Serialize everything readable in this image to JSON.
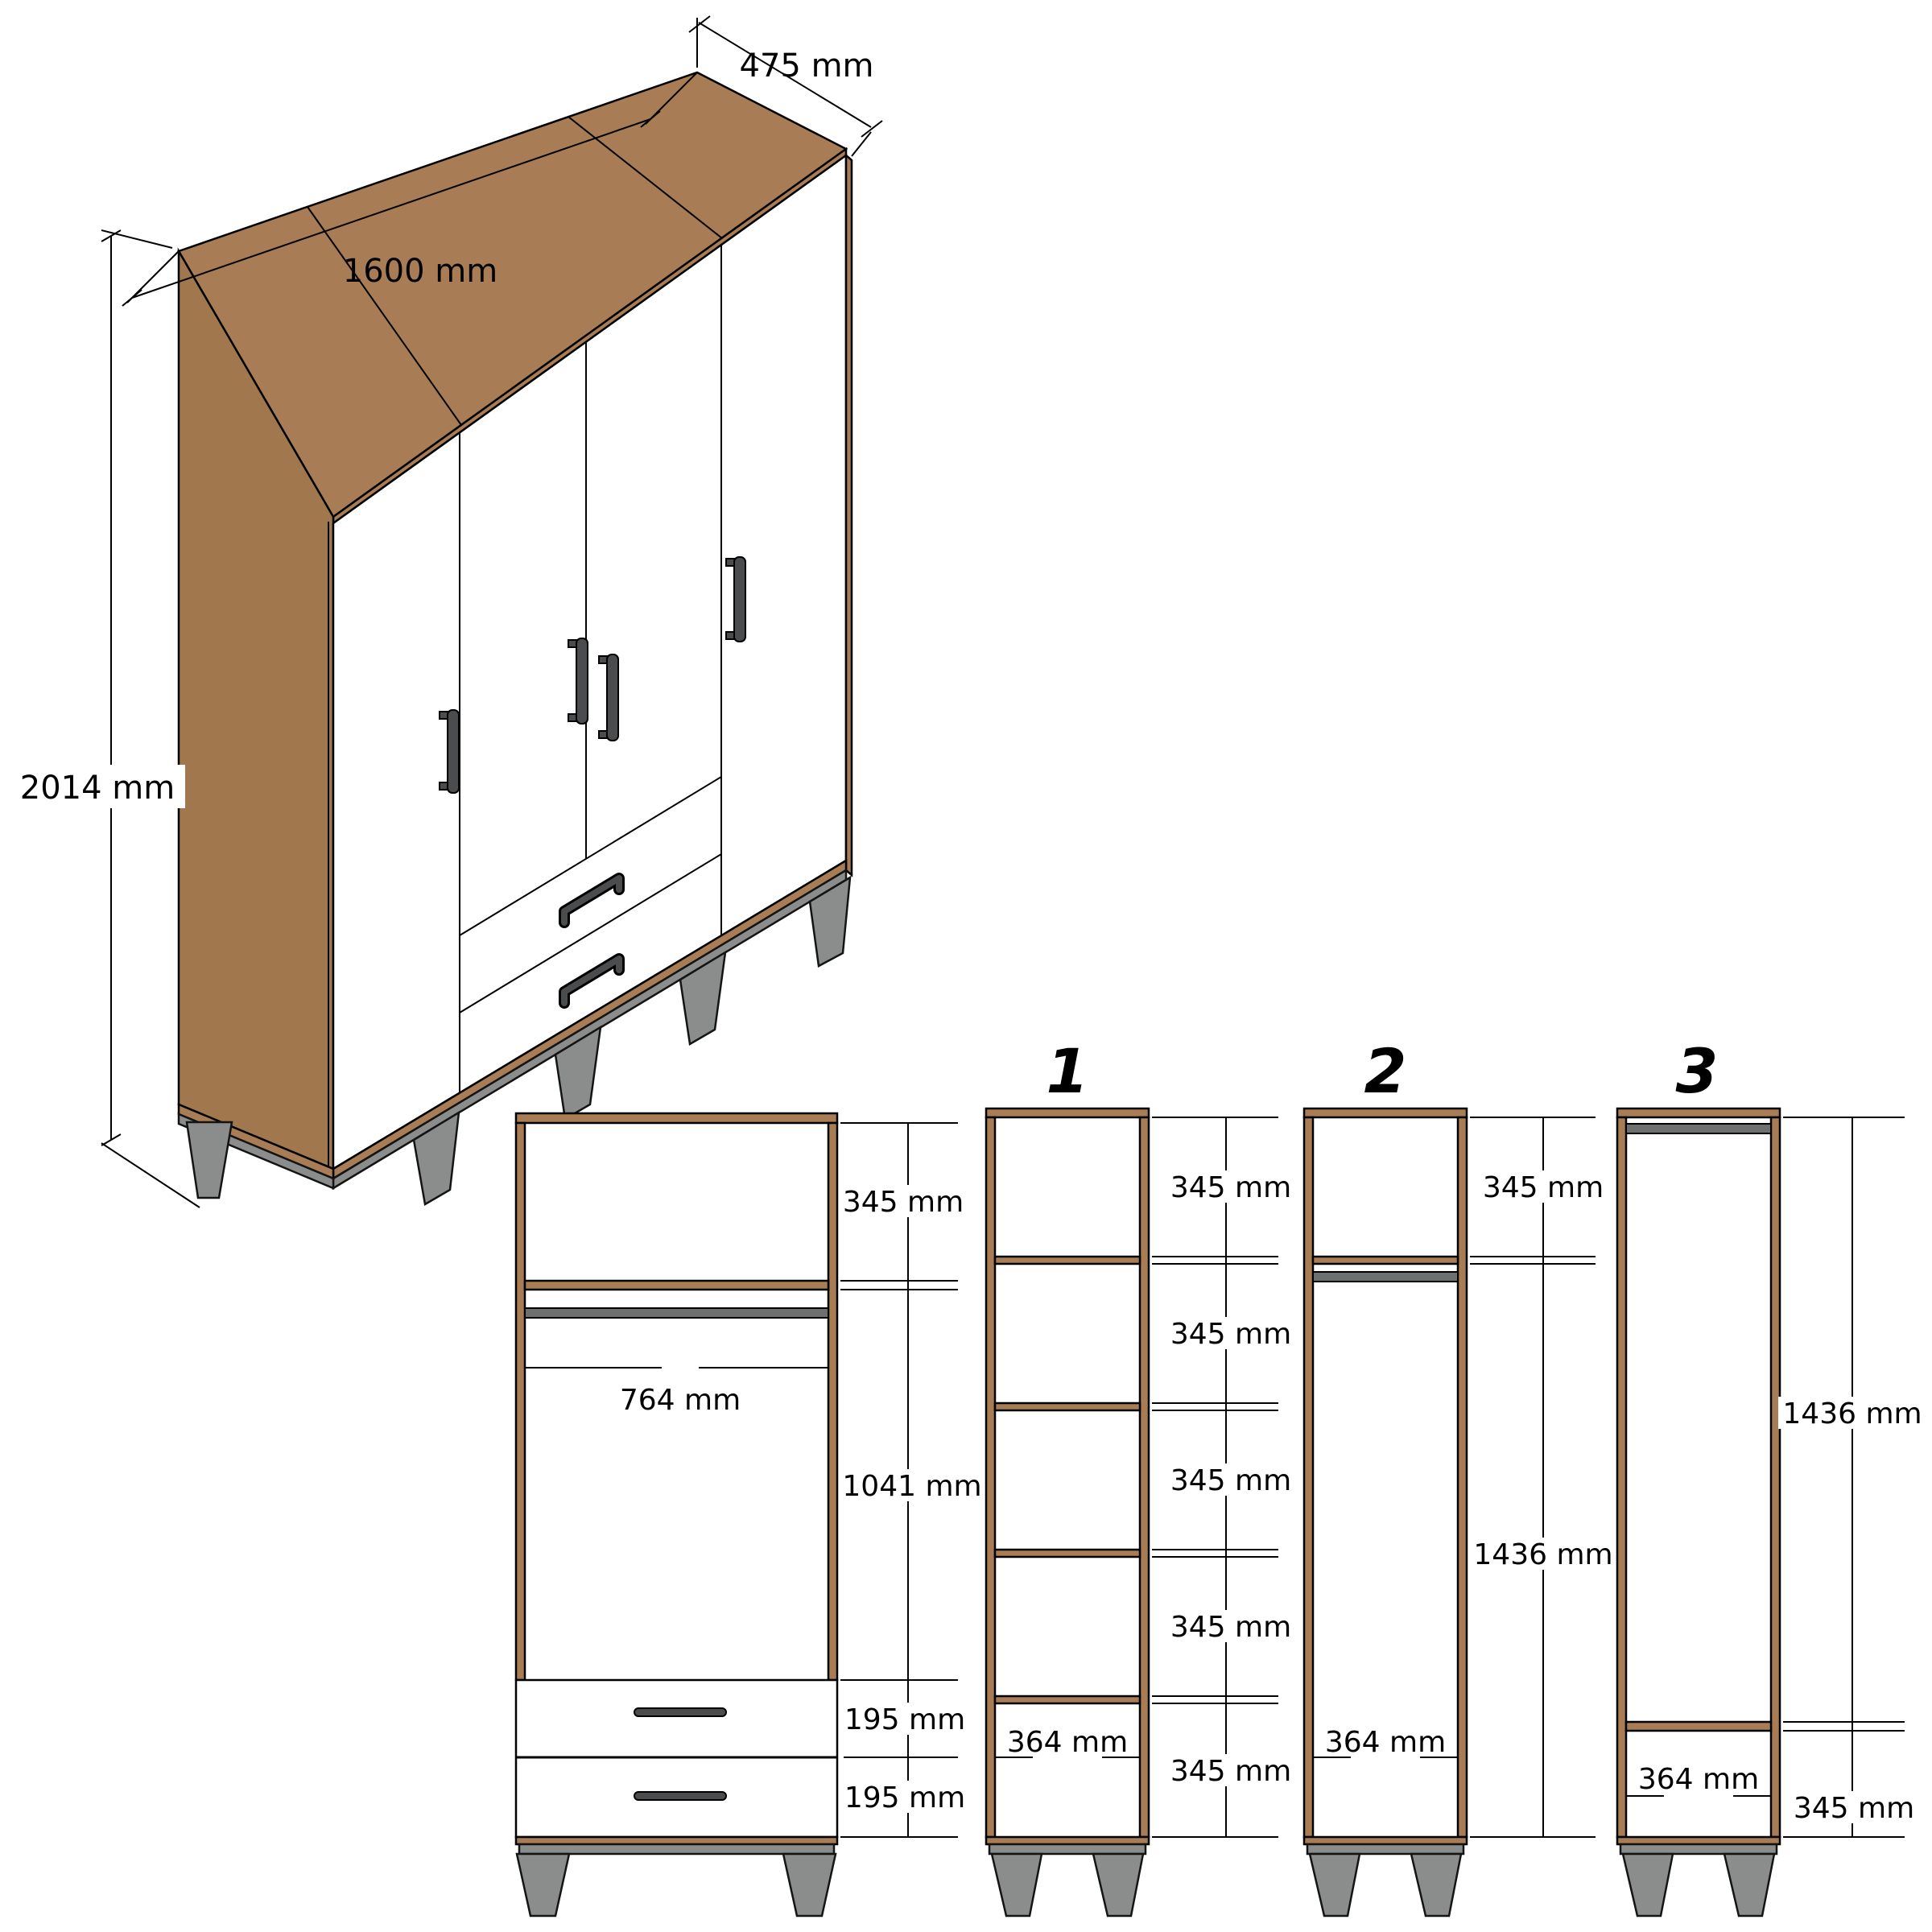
{
  "iso": {
    "width": "1600 mm",
    "depth": "475 mm",
    "height": "2014 mm"
  },
  "middle_section": {
    "top": "345 mm",
    "inner_width": "764 mm",
    "hanging": "1041 mm",
    "drawer_top": "195 mm",
    "drawer_bottom": "195 mm"
  },
  "column1": {
    "number": "1",
    "width": "364 mm",
    "shelves": [
      "345 mm",
      "345 mm",
      "345 mm",
      "345 mm",
      "345 mm"
    ]
  },
  "column2": {
    "number": "2",
    "width": "364 mm",
    "top": "345 mm",
    "hanging": "1436 mm"
  },
  "column3": {
    "number": "3",
    "width": "364 mm",
    "hanging": "1436 mm",
    "bottom": "345 mm"
  },
  "colors": {
    "wood": "#A87C54",
    "wood_side": "#A1774E",
    "metal": "#8B8C8C",
    "rod": "#6E7070",
    "outline": "#000000",
    "background": "#FFFFFF"
  }
}
